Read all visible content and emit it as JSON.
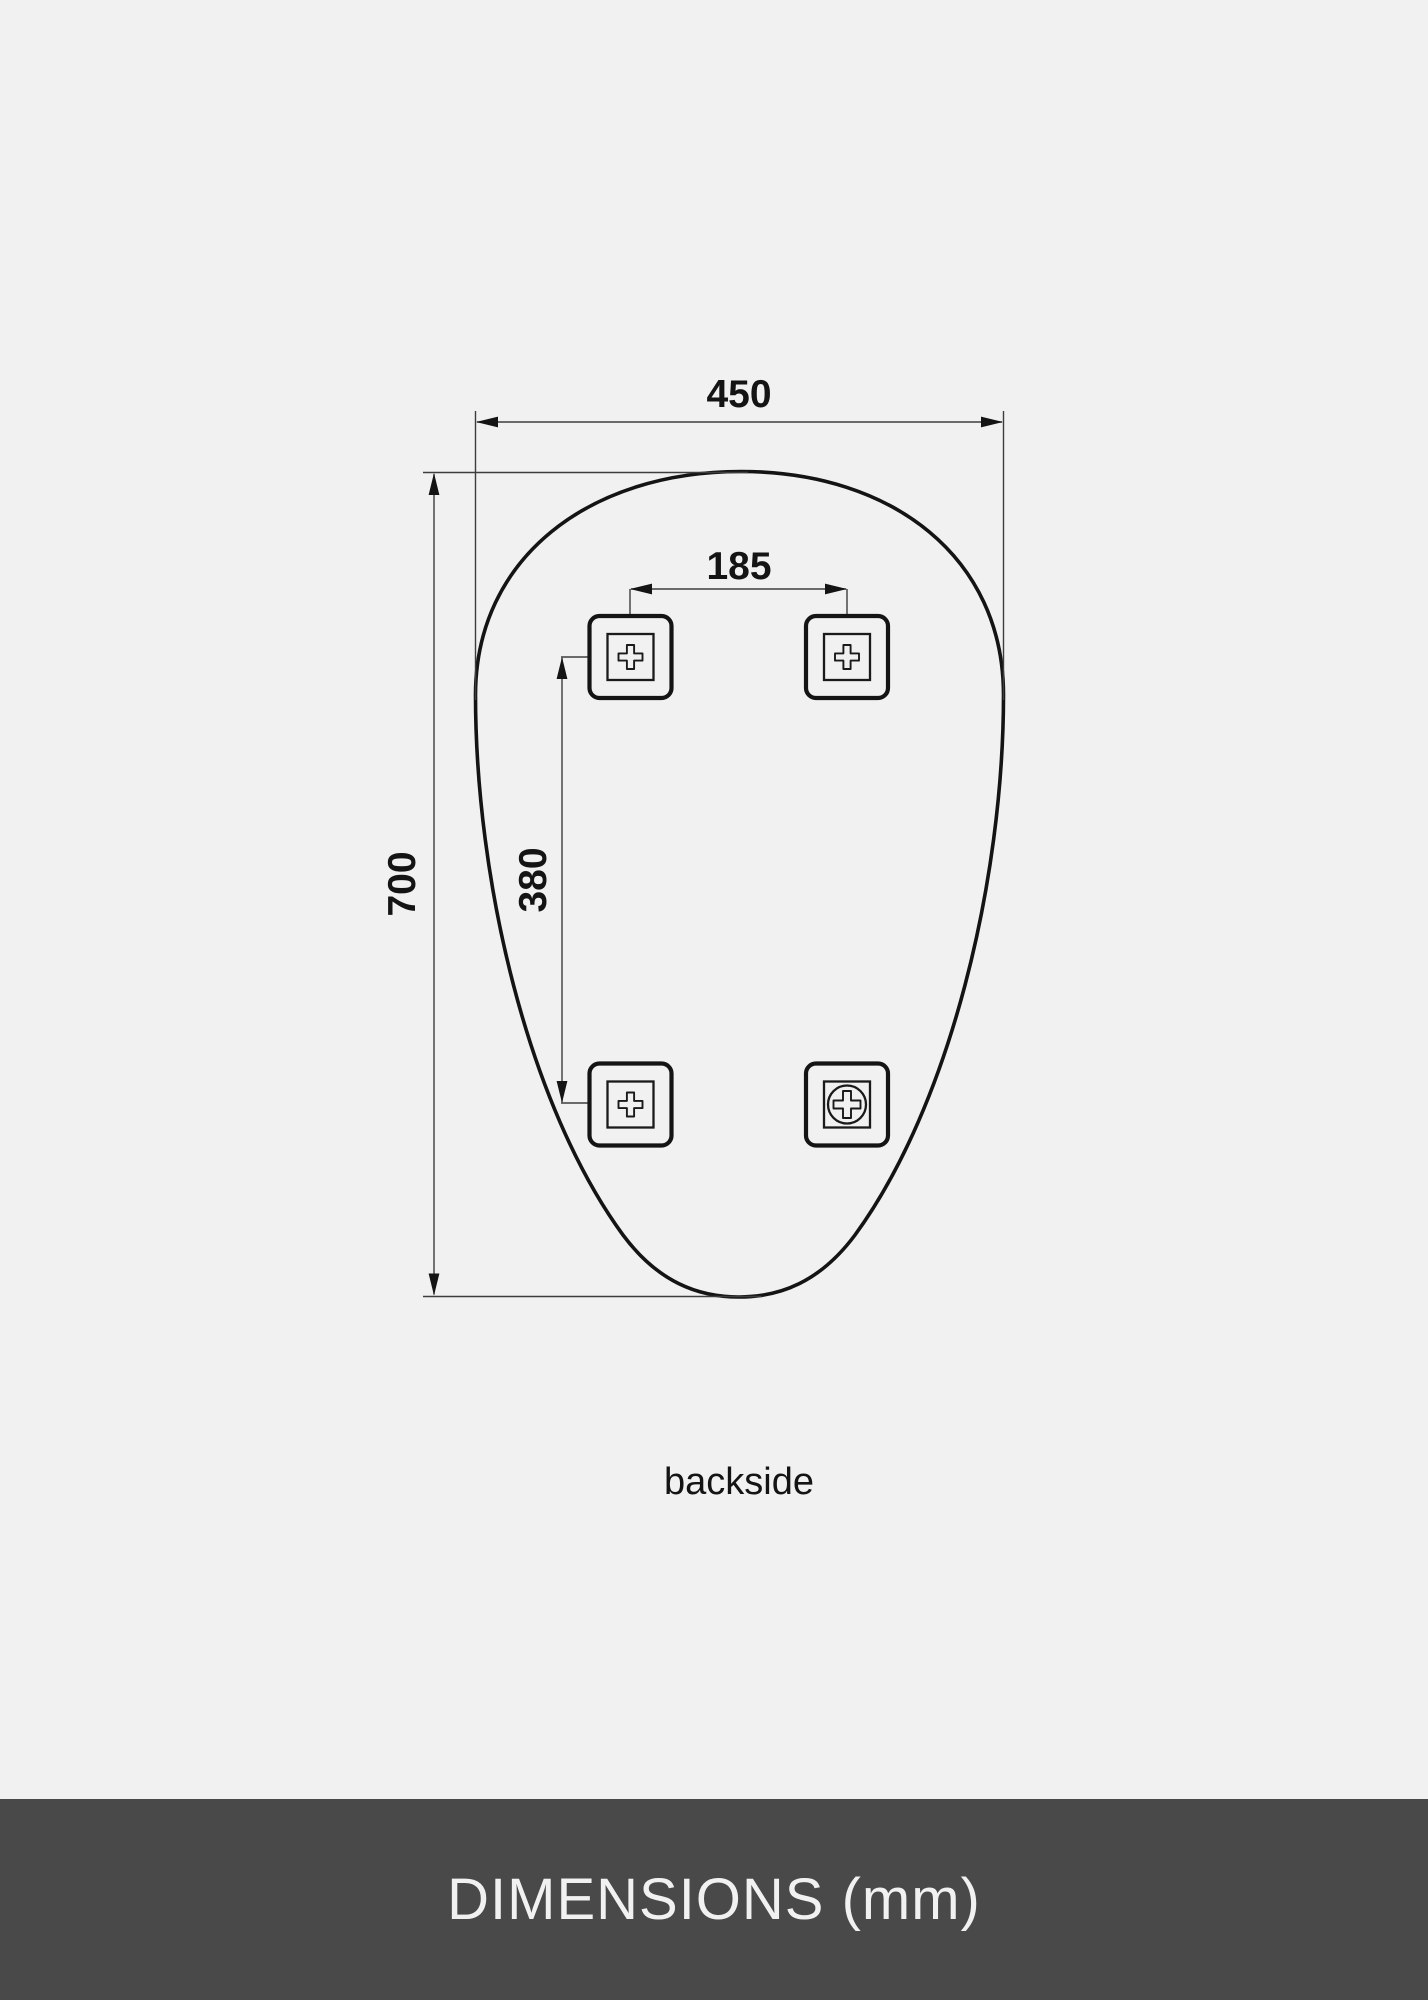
{
  "page": {
    "background_color": "#f1f1f2",
    "ink_color": "#141414"
  },
  "drawing": {
    "caption": "backside",
    "dimensions": {
      "overall_width_mm": "450",
      "overall_height_mm": "700",
      "bracket_spacing_horizontal_mm": "185",
      "bracket_spacing_vertical_mm": "380"
    },
    "brackets": {
      "count": 4,
      "marks": [
        "cross",
        "cross",
        "cross",
        "screw"
      ]
    }
  },
  "footer": {
    "label": "DIMENSIONS (mm)",
    "background_color": "#494949",
    "text_color": "#f1f1f1"
  }
}
